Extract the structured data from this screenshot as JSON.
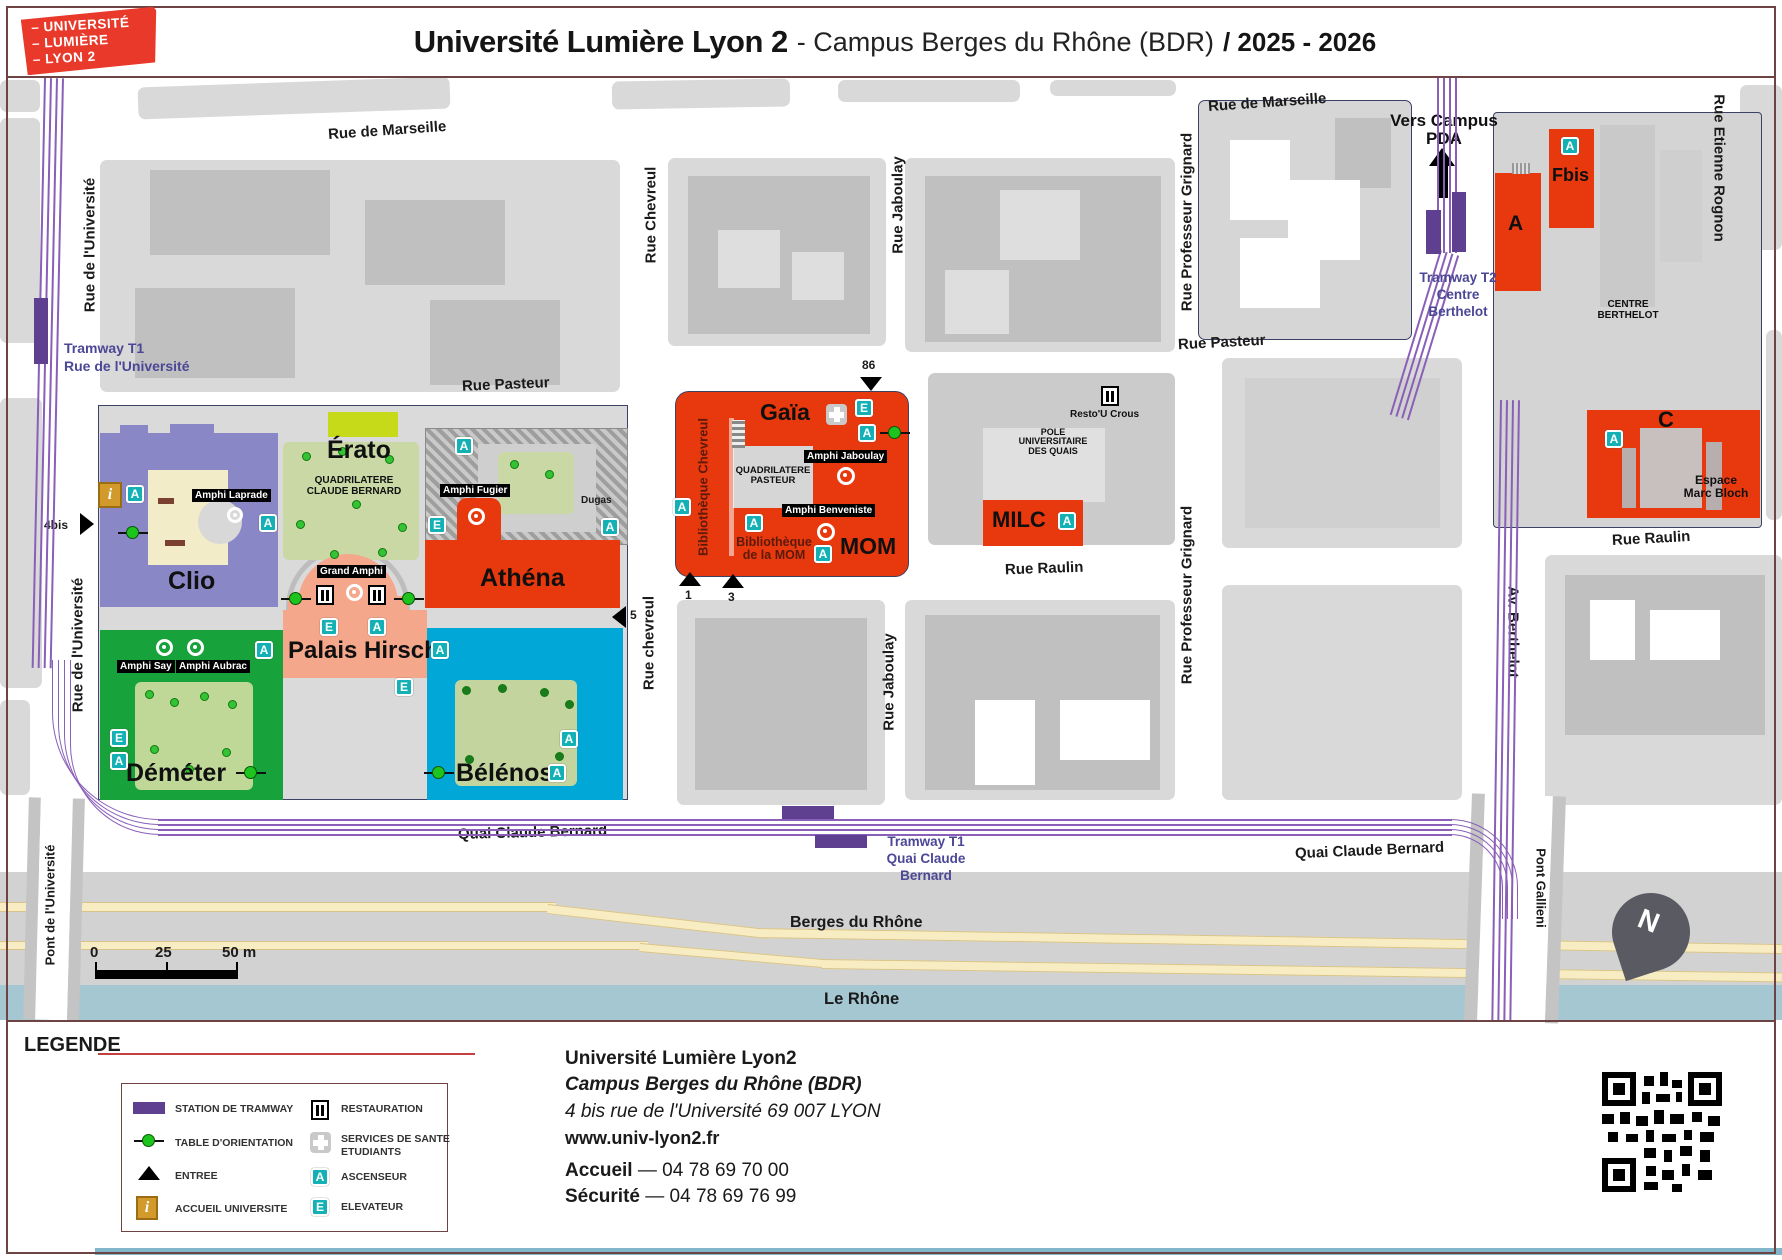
{
  "header": {
    "logo": [
      "– UNIVERSITÉ",
      "– LUMIÈRE",
      "– LYON 2"
    ],
    "title": "Université Lumière Lyon 2",
    "subtitle": "- Campus Berges du Rhône (BDR)",
    "year": "/ 2025 - 2026"
  },
  "map": {
    "streets": {
      "marseille": "Rue de Marseille",
      "pasteur": "Rue Pasteur",
      "universite": "Rue de l'Université",
      "chevreul_top": "Rue Chevreul",
      "chevreul_bottom": "Rue chevreul",
      "jaboulay": "Rue Jaboulay",
      "grignard": "Rue Professeur Grignard",
      "rognon": "Rue Etienne Rognon",
      "av_berthelot": "Av. Berthelot",
      "raulin": "Rue Raulin",
      "quai": "Quai Claude Bernard",
      "pont_universite": "Pont de l'Université",
      "pont_gallieni": "Pont Gallieni",
      "berges": "Berges du Rhône",
      "rhone": "Le  Rhône",
      "dugas": "Dugas",
      "centre_berthelot": "CENTRE\nBERTHELOT"
    },
    "tram": {
      "t1_universite": "Tramway T1\nRue de l'Université",
      "t1_quai": "Tramway T1\nQuai Claude\nBernard",
      "t2": "Tramway T2\nCentre\nBerthelot",
      "vers_pda": "Vers Campus\nPDA"
    },
    "buildings": {
      "clio": "Clio",
      "erato": "Érato",
      "athena": "Athéna",
      "palais_hirsch": "Palais Hirsch",
      "demeter": "Déméter",
      "belenos": "Bélénos",
      "gaia": "Gaïa",
      "mom": "MOM",
      "milc": "MILC",
      "a": "A",
      "fbis": "Fbis",
      "c": "C",
      "espace_marc_bloch": "Espace\nMarc Bloch"
    },
    "areas": {
      "quad_claude_bernard": "QUADRILATERE\nCLAUDE BERNARD",
      "quad_pasteur": "QUADRILATERE\nPASTEUR",
      "pole_quais": "POLE\nUNIVERSITAIRE\nDES QUAIS",
      "resto_crous": "Resto'U Crous",
      "bib_chevreul": "Bibliothèque Chevreul",
      "bib_mom": "Bibliothèque\nde la MOM"
    },
    "amphis": {
      "laprade": "Amphi Laprade",
      "fugier": "Amphi Fugier",
      "say": "Amphi Say",
      "aubrac": "Amphi Aubrac",
      "grand": "Grand Amphi",
      "jaboulay": "Amphi Jaboulay",
      "benveniste": "Amphi Benveniste"
    },
    "entrances": {
      "e4bis": "4bis",
      "e5": "5",
      "e86": "86",
      "e1": "1",
      "e3": "3"
    },
    "scale": {
      "zero": "0",
      "mid": "25",
      "end": "50 m"
    },
    "compass": "N",
    "icon_letters": {
      "ascenseur": "A",
      "elevateur": "E",
      "info": "i"
    }
  },
  "legend": {
    "title": "LEGENDE",
    "items": [
      {
        "label": "STATION DE TRAMWAY"
      },
      {
        "label": "TABLE D'ORIENTATION"
      },
      {
        "label": "ENTREE"
      },
      {
        "label": "ACCUEIL UNIVERSITE"
      },
      {
        "label": "RESTAURATION"
      },
      {
        "label": "SERVICES DE SANTE\nETUDIANTS"
      },
      {
        "label": "ASCENSEUR"
      },
      {
        "label": "ELEVATEUR"
      }
    ]
  },
  "contact": {
    "name": "Université Lumière Lyon2",
    "campus": "Campus Berges du Rhône (BDR)",
    "address": "4 bis rue de l'Université 69 007 LYON",
    "website": "www.univ-lyon2.fr",
    "accueil_label": "Accueil",
    "accueil_phone": "— 04 78 69 70 00",
    "securite_label": "Sécurité",
    "securite_phone": "— 04 78 69 76 99"
  },
  "colors": {
    "university_red": "#e8380d",
    "tram_purple": "#8a5fb8",
    "station_purple": "#5f3f8f",
    "teal_icon": "#13b1b5",
    "clio_purple": "#8a87c6",
    "erato_green": "#c7da1a",
    "palais_salmon": "#f5a78c",
    "demeter_green": "#17a23b",
    "belenos_cyan": "#00a7d7",
    "river_blue": "#a4c7d2",
    "accueil_gold": "#d29a2b",
    "border_maroon": "#6e4343"
  }
}
